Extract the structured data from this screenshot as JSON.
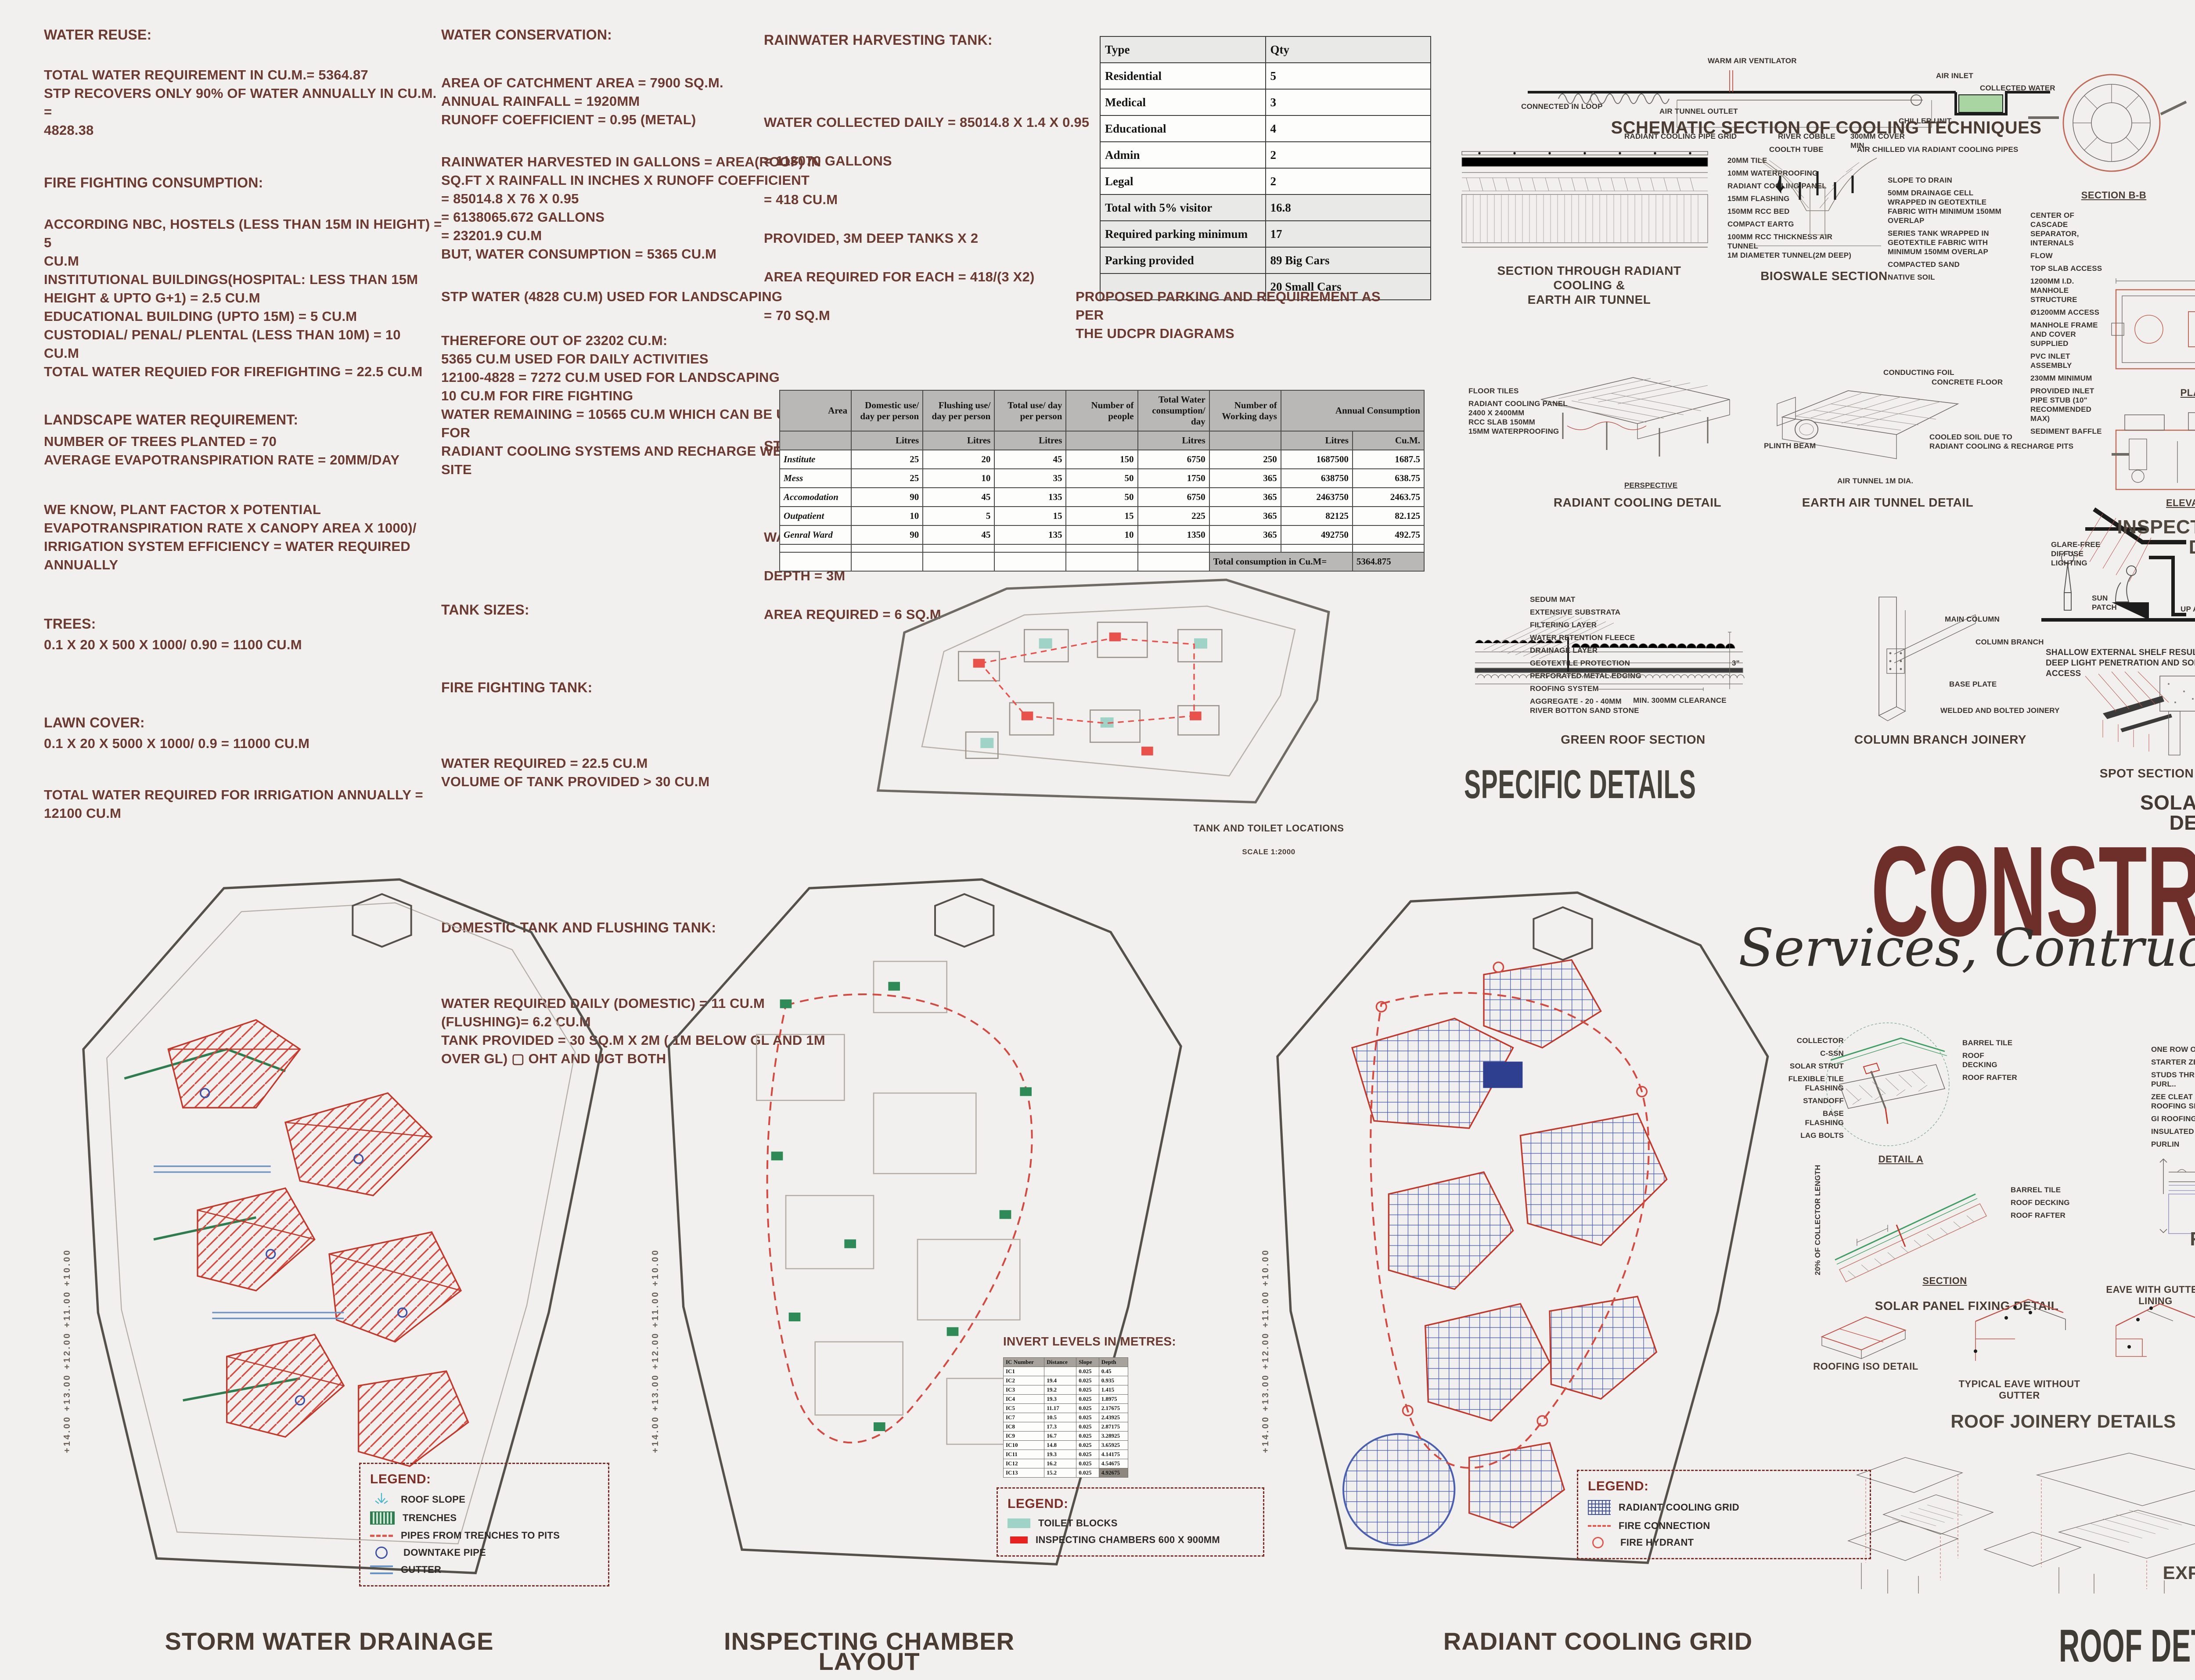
{
  "colors": {
    "accent_maroon": "#6e2f2b",
    "note_text": "#6b3a31",
    "label_dark": "#45423b",
    "legend_red": "#e8231f",
    "teal": "#9fd3c8",
    "green": "#2e7d4f",
    "grid_blue": "#3f51a5",
    "collected_water_green": "#a8d5a2"
  },
  "title_block": {
    "title": "CONSTRUCTION TECHNIQUES",
    "subtitle": "Services, Contruction Techniques & Details"
  },
  "notes": {
    "col1": {
      "water_reuse_h": "WATER REUSE:",
      "water_reuse_b": "TOTAL WATER REQUIREMENT IN CU.M.= 5364.87\nSTP RECOVERS ONLY 90% OF WATER ANNUALLY IN CU.M. =\n4828.38",
      "fire_h": "FIRE FIGHTING CONSUMPTION:",
      "fire_b": "ACCORDING NBC, HOSTELS (LESS THAN 15M IN HEIGHT) = 5\nCU.M\n      INSTITUTIONAL BUILDINGS(HOSPITAL: LESS THAN 15M\nHEIGHT & UPTO G+1) = 2.5 CU.M\n      EDUCATIONAL BUILDING (UPTO 15M) = 5 CU.M\n      CUSTODIAL/ PENAL/ PLENTAL (LESS THAN 10M) = 10\nCU.M\nTOTAL WATER REQUIED FOR FIREFIGHTING = 22.5 CU.M",
      "landscape_h": "LANDSCAPE WATER REQUIREMENT:",
      "landscape_b": "NUMBER OF TREES PLANTED = 70\nAVERAGE EVAPOTRANSPIRATION RATE = 20MM/DAY",
      "weknow_b": "WE KNOW, PLANT FACTOR X POTENTIAL\nEVAPOTRANSPIRATION RATE X CANOPY AREA X 1000)/\nIRRIGATION SYSTEM EFFICIENCY = WATER REQUIRED\nANNUALLY",
      "trees_h": "TREES:",
      "trees_b": "0.1 X 20 X 500 X 1000/ 0.90 = 1100 CU.M",
      "lawn_h": "LAWN COVER:",
      "lawn_b": "0.1 X 20 X 5000 X 1000/ 0.9 = 11000 CU.M",
      "total_irrigation": "TOTAL WATER REQUIRED FOR IRRIGATION ANNUALLY =\n12100 CU.M"
    },
    "col2": {
      "conservation_h": "WATER CONSERVATION:",
      "conservation_b1": "AREA OF CATCHMENT AREA = 7900 SQ.M.\nANNUAL RAINFALL = 1920MM\nRUNOFF COEFFICIENT = 0.95 (METAL)",
      "conservation_b2": "RAINWATER HARVESTED IN GALLONS = AREA(ROOF) IN\nSQ.FT  X RAINFALL IN INCHES X RUNOFF COEFFICIENT\n   = 85014.8 X 76 X 0.95\n   = 6138065.672 GALLONS\n   = 23201.9 CU.M\nBUT, WATER CONSUMPTION = 5365 CU.M",
      "conservation_b3": "STP WATER (4828 CU.M) USED FOR LANDSCAPING",
      "conservation_b4": "THEREFORE OUT OF 23202 CU.M:\n   5365 CU.M USED FOR DAILY ACTIVITIES\n   12100-4828 = 7272 CU.M USED FOR LANDSCAPING\n   10 CU.M FOR FIRE FIGHTING\nWATER REMAINING = 10565 CU.M WHICH CAN BE USED FOR\nRADIANT COOLING SYSTEMS AND RECHARGE WELLS ON\nSITE",
      "tank_sizes_h": "TANK SIZES:",
      "fire_tank_h": "FIRE FIGHTING TANK:",
      "fire_tank_b": "WATER REQUIRED = 22.5 CU.M\nVOLUME OF TANK PROVIDED > 30 CU.M",
      "domestic_h": "DOMESTIC TANK AND FLUSHING TANK:",
      "domestic_b": "WATER REQUIRED DAILY (DOMESTIC) = 11 CU.M\n      (FLUSHING)= 6.2 CU.M\nTANK PROVIDED = 30 SQ.M X 2M ( 1M BELOW GL AND 1M\nOVER GL) ▢ OHT AND UGT BOTH"
    },
    "col3": {
      "rain_tank_h": "RAINWATER HARVESTING TANK:",
      "rain_tank_b": "WATER COLLECTED DAILY = 85014.8 X 1.4 X 0.95\n= 113070 GALLONS\n=  418 CU.M\nPROVIDED, 3M DEEP TANKS X 2\n   AREA REQUIRED FOR EACH = 418/(3 X2)\n          = 70 SQ.M",
      "stp_tank_h": "STP TANK:",
      "stp_tank_b": "WATER TREATED = 17 CU.M DAILY\nDEPTH = 3M\nAREA REQUIRED = 6 SQ.M"
    },
    "parking_caption": "PROPOSED PARKING AND REQUIREMENT AS PER\nTHE UDCPR DIAGRAMS"
  },
  "parking_table": {
    "header_rows": [
      [
        "Type",
        "Qty"
      ]
    ],
    "rows": [
      [
        "Residential",
        "5"
      ],
      [
        "Medical",
        "3"
      ],
      [
        "Educational",
        "4"
      ],
      [
        "Admin",
        "2"
      ],
      [
        "Legal",
        "2"
      ],
      [
        "Total with 5% visitor",
        "16.8"
      ],
      [
        "Required parking minimum",
        "17"
      ],
      [
        "Parking provided",
        "89 Big Cars"
      ],
      [
        "",
        "20 Small Cars"
      ]
    ]
  },
  "consumption_table": {
    "header_rows": [
      [
        "Area",
        "Domestic use/ day per person",
        "Flushing use/ day per person",
        "Total use/ day per person",
        "Number of people",
        "Total Water consumption/ day",
        "Number of Working days",
        {
          "t": "Annual Consumption",
          "cs": 2
        }
      ],
      [
        "",
        "Litres",
        "Litres",
        "Litres",
        "",
        "Litres",
        "",
        "Litres",
        "Cu.M."
      ]
    ],
    "rows": [
      [
        "Institute",
        "25",
        "20",
        "45",
        "150",
        "6750",
        "250",
        "1687500",
        "1687.5"
      ],
      [
        "Mess",
        "25",
        "10",
        "35",
        "50",
        "1750",
        "365",
        "638750",
        "638.75"
      ],
      [
        "Accomodation",
        "90",
        "45",
        "135",
        "50",
        "6750",
        "365",
        "2463750",
        "2463.75"
      ],
      [
        "Outpatient",
        "10",
        "5",
        "15",
        "15",
        "225",
        "365",
        "82125",
        "82.125"
      ],
      [
        "Genral Ward",
        "90",
        "45",
        "135",
        "10",
        "1350",
        "365",
        "492750",
        "492.75"
      ],
      [
        "",
        "",
        "",
        "",
        "",
        "",
        "",
        "",
        ""
      ],
      [
        "",
        "",
        "",
        "",
        "",
        "",
        {
          "t": "Total consumption in Cu.M=",
          "cs": 2,
          "cls": "shade"
        },
        {
          "t": "5364.875",
          "cls": "shade"
        }
      ]
    ]
  },
  "invert_levels": {
    "heading": "INVERT LEVELS IN METRES:",
    "table": {
      "header_rows": [
        [
          "IC Number",
          "Distance",
          "Slope",
          "Depth"
        ]
      ],
      "rows": [
        [
          "IC1",
          "",
          "0.025",
          "0.45"
        ],
        [
          "IC2",
          "19.4",
          "0.025",
          "0.935"
        ],
        [
          "IC3",
          "19.2",
          "0.025",
          "1.415"
        ],
        [
          "IC4",
          "19.3",
          "0.025",
          "1.8975"
        ],
        [
          "IC5",
          "11.17",
          "0.025",
          "2.17675"
        ],
        [
          "IC7",
          "10.5",
          "0.025",
          "2.43925"
        ],
        [
          "IC8",
          "17.3",
          "0.025",
          "2.87175"
        ],
        [
          "IC9",
          "16.7",
          "0.025",
          "3.28925"
        ],
        [
          "IC10",
          "14.8",
          "0.025",
          "3.65925"
        ],
        [
          "IC11",
          "19.3",
          "0.025",
          "4.14175"
        ],
        [
          "IC12",
          "16.2",
          "0.025",
          "4.54675"
        ],
        [
          "IC13",
          "15.2",
          "0.025",
          {
            "t": "4.92675",
            "cls": "dk"
          }
        ]
      ]
    }
  },
  "site_plans": {
    "tank_toilet": {
      "label_line1": "TANK AND TOILET LOCATIONS",
      "label_line2": "SCALE 1:2000"
    },
    "storm": {
      "label": "STORM WATER DRAINAGE",
      "markers": "+14.00   +13.00   +12.00   +11.00   +10.00",
      "legend_title": "LEGEND:",
      "legend": [
        "ROOF SLOPE",
        "TRENCHES",
        "PIPES FROM TRENCHES TO PITS",
        "DOWNTAKE PIPE",
        "GUTTER"
      ]
    },
    "chamber": {
      "label": "INSPECTING CHAMBER LAYOUT",
      "markers": "+14.00   +13.00   +12.00   +11.00   +10.00",
      "legend_title": "LEGEND:",
      "legend": [
        "TOILET BLOCKS",
        "INSPECTING CHAMBERS 600 X 900MM"
      ]
    },
    "radiant": {
      "label": "RADIANT COOLING GRID",
      "markers": "+14.00   +13.00   +12.00   +11.00   +10.00",
      "legend_title": "LEGEND:",
      "legend": [
        "RADIANT COOLING GRID",
        "FIRE CONNECTION",
        "FIRE HYDRANT"
      ]
    }
  },
  "cooling_details": {
    "schematic": {
      "caption": "SCHEMATIC SECTION OF COOLING TECHNIQUES",
      "callouts": [
        "CONNECTED IN LOOP",
        "AIR TUNNEL OUTLET",
        "WARM AIR VENTILATOR",
        "RADIANT COOLING PIPE GRID",
        "COOLTH TUBE",
        "AIR CHILLED VIA RADIANT COOLING PIPES",
        "CHILLER UNIT",
        "AIR INLET",
        "COLLECTED WATER"
      ]
    },
    "section_through": {
      "caption": "SECTION THROUGH RADIANT COOLING &\nEARTH AIR TUNNEL",
      "callouts": [
        "20MM TILE",
        "10MM WATERPROOFING",
        "RADIANT COOLING PANEL",
        "15MM FLASHING",
        "150MM RCC BED",
        "COMPACT EARTG",
        "100MM RCC THICKNESS AIR TUNNEL\n1M DIAMETER TUNNEL(2M DEEP)"
      ]
    },
    "bioswale": {
      "caption": "BIOSWALE SECTION",
      "callouts_left": [
        "RIVER COBBLE",
        "300MM COVER\nMIN."
      ],
      "callouts_right": [
        "SLOPE TO DRAIN",
        "50MM DRAINAGE CELL WRAPPED IN GEOTEXTILE FABRIC WITH MINIMUM 150MM OVERLAP",
        "SERIES TANK WRAPPED IN GEOTEXTILE FABRIC WITH MINIMUM 150MM OVERLAP",
        "COMPACTED SAND",
        "NATIVE SOIL"
      ],
      "dims": [
        "50",
        "150",
        "150"
      ]
    },
    "radiant_detail": {
      "caption": "RADIANT COOLING DETAIL",
      "tag": "PERSPECTIVE",
      "callouts": [
        "FLOOR TILES",
        "RADIANT COOLING PANEL\n2400 X 2400MM\nRCC SLAB 150MM\n15MM WATERPROOFING"
      ]
    },
    "earth_tunnel": {
      "caption": "EARTH AIR TUNNEL DETAIL",
      "callouts": [
        "CONDUCTING FOIL",
        "CONCRETE FLOOR",
        "PLINTH BEAM",
        "COOLED SOIL DUE TO\nRADIANT COOLING & RECHARGE PITS",
        "AIR TUNNEL 1M DIA."
      ]
    },
    "green_roof": {
      "caption": "GREEN ROOF SECTION",
      "dim": "MIN. 300MM CLEARANCE",
      "dim2": "3\"",
      "callouts": [
        "SEDUM MAT",
        "EXTENSIVE SUBSTRATA",
        "FILTERING LAYER",
        "WATER RETENTION FLEECE",
        "DRAINAGE LAYER",
        "GEOTEXTILE PROTECTION",
        "PERFORATED METAL EDGING",
        "ROOFING SYSTEM",
        "AGGREGATE - 20 - 40MM\nRIVER BOTTON SAND STONE"
      ]
    },
    "column_branch": {
      "caption": "COLUMN BRANCH JOINERY",
      "callouts": [
        "MAIN COLUMN",
        "COLUMN BRANCH",
        "BASE PLATE",
        "WELDED AND BOLTED JOINERY"
      ]
    },
    "specific_big": "SPECIFIC DETAILS"
  },
  "solar_shelf": {
    "shallow": {
      "callout1": "GLARE-FREE\nDIFFUSE\nLIGHTING",
      "callout2": "SUN\nPATCH",
      "note": "SHALLOW EXTERNAL SHELF RESULTS IN\nDEEP LIGHT PENETRATION AND SOLAR\nACCESS"
    },
    "view": {
      "caption": "SOLAR SHELF VIEW",
      "callout_left": "RAIL FOR MOVING\nUP AND DOWN",
      "callouts": [
        "LIGHT SHELF MODULE:\nSOLAR MODULE",
        "UPPER DAYLIGHTING HOLE",
        "LIGHT SHELF LOWER MODULE:\nREFLECTOR",
        "VERTICAL FOLDING STRUCTURE",
        "DAYLIGHTING WINDOW"
      ]
    },
    "spot": {
      "caption": "SPOT SECTION",
      "callouts": [
        "SOLAR MODULE\n(GENERATION)",
        "REFLECTOR (DAYLIGHTING)",
        "DAYLIGHTING WINDOW"
      ]
    },
    "big": "SOLAR SHELF DETAILS"
  },
  "inspection": {
    "caption": "INSPECTION CHAMBER DETAILS",
    "sec_bb": "SECTION B-B",
    "sec_aa": "SECTION A-A",
    "plan": "PLAN VIEW",
    "top_frame": "TOP VIEW\nFRAME AND COVER",
    "elev": "ELEVATION VIEW",
    "top_hatch": "TOP VIEW\nHATCH",
    "callouts_left": [
      "CENTER OF CASCADE SEPARATOR, INTERNALS",
      "FLOW",
      "TOP SLAB ACCESS",
      "1200MM I.D. MANHOLE STRUCTURE",
      "Ø1200MM ACCESS",
      "MANHOLE FRAME AND COVER SUPPLIED",
      "PVC INLET ASSEMBLY",
      "230MM MINIMUM",
      "PROVIDED INLET PIPE STUB (10\" RECOMMENDED MAX)",
      "SEDIMENT BAFFLE"
    ],
    "callouts_right": [
      "OUTLET PIPE",
      "INLET PIPE (MULTIPLE INLET PIPES MAY BE ACCOMMODATED)",
      "SOLIDS STORAGE SUMP",
      "PERMANENT POOL ELEV.",
      "685MM · VARIES · 1200MM · 600MM",
      "3600MM · 915MM · 1200MM ACCESS OPENING",
      "915MM ACCESS OPENING · 1800MM · Ø600MM",
      "ACCESS HATCH",
      "GRADE RINGS/RISERS, SLAB TO MEET FINISHED GRADE",
      "PVC OUTLET ASSEMBLY · 1800MM TYP",
      "PROVIDED OUTLET PIPE STUB (250MM RECOMMENDED MAX)",
      "1200MM · 915MM"
    ]
  },
  "wall_details": {
    "elevation": {
      "caption": "DRY WALL ELEVATION",
      "callout": "DRYWALL PANELS BOLTED ON FRAMEWORK",
      "dims": "2000 / 2000"
    },
    "framing": {
      "caption": "FRAMING MEMBER CROSS SECTION",
      "dims": [
        "38MM",
        "4.5MM",
        "10MM",
        "10 MM"
      ]
    },
    "fixing": {
      "caption": "DRYWALL FIXING\n(SUPORT FRAMEWORK VERTICAL)",
      "dims": "1200 · 600 · 600 · 1200 · 4000"
    },
    "column_junction": {
      "caption": "DRYWALL TO COLUMN JUNCTION",
      "callouts": [
        "BOLTED DRYWALL",
        "STEEL COLUMN",
        "SEALANT",
        "PROTECTIVE VARNISH"
      ]
    },
    "plate_clip": {
      "caption": "PLATE CLIP AT JUNCTION OF FRAMEWORK",
      "callouts": [
        "CLIP FOLD",
        "FRAMING MEMBER",
        "HORIZONTAL FRAMING MEMBER",
        "VERTICAL FRAMING MEMBER"
      ]
    },
    "wall_junction": {
      "caption": "WALL JUNCTION DETAIL",
      "callouts": [
        "DRYWALL",
        "T-WALL JUNCTION",
        "BOLTED DRYWALL",
        "FRAMING MEMBER",
        "SEALANT",
        "600MM"
      ]
    },
    "fastening": {
      "caption": "FASTENING DETAIL OF PARTITION",
      "callouts": [
        "DRYWALL",
        "FRAMING MEMBER",
        "BOLTED DRYWALL 22MM",
        "SEALANT"
      ]
    },
    "big": "WALL DETAILS"
  },
  "roof_details": {
    "solar_fix": {
      "caption": "SOLAR PANEL FIXING DETAIL",
      "detail_a": "DETAIL A",
      "section": "SECTION",
      "rot": "20% OF COLLECTOR LENGTH",
      "callouts_left": [
        "COLLECTOR",
        "C-SSN",
        "SOLAR STRUT",
        "FLEXIBLE TILE FLASHING",
        "STANDOFF",
        "BASE FLASHING",
        "LAG BOLTS"
      ],
      "callouts_right": [
        "BARREL TILE",
        "ROOF DECKING",
        "ROOF RAFTER"
      ]
    },
    "roof_fix": {
      "caption": "ROOF FIXING SECTION",
      "callouts": [
        "ONE ROW OF TAPE SEALANT",
        "STARTER ZEE CLEAT",
        "STUDS THROUGH CLEAT INTO PURL..",
        "ZEE CLEAT AND BENT ROOFING SHEET",
        "GI ROOFING SHEET",
        "INSULATED ROOFING PANELS",
        "PURLIN"
      ]
    },
    "joinery": {
      "caption": "ROOF JOINERY DETAILS",
      "subs": [
        "ROOFING ISO DETAIL",
        "EAVE WITH GUTTER LINING",
        "TYPICAL EAVE WITHOUT GUTTER",
        "SECTIONAL VIEW: RIDGE DETAIL"
      ],
      "callouts": [
        "ROOF APRON",
        "GUTTER LINING",
        "CONTINUOUS COPPER RIDGE W/ ROOF APRON",
        "STANDING SEAM LAID OVER 150MM FROM RIDGE"
      ]
    },
    "exploded": "EXPLODED ROOFING LAYERS",
    "big": "ROOF DETAILS"
  },
  "structural": {
    "plans": [
      {
        "name": "CENTRELINE PLAN",
        "scale": "SCALE 1:200"
      },
      {
        "name": "PLINTH BEAM LAYOUT",
        "scale": "SCALE 1:500"
      },
      {
        "name": "SLAB BEAM LAYOUT",
        "scale": "SCALE 1:500"
      },
      {
        "name": "ROOFING BEAM LAYOUT",
        "scale": "SCALE 1:500"
      },
      {
        "name": "ROOF PLAN",
        "scale": "SCALE 1:500"
      }
    ],
    "big": "TYPICAL STRUCTURAL PLANS: EMS"
  }
}
